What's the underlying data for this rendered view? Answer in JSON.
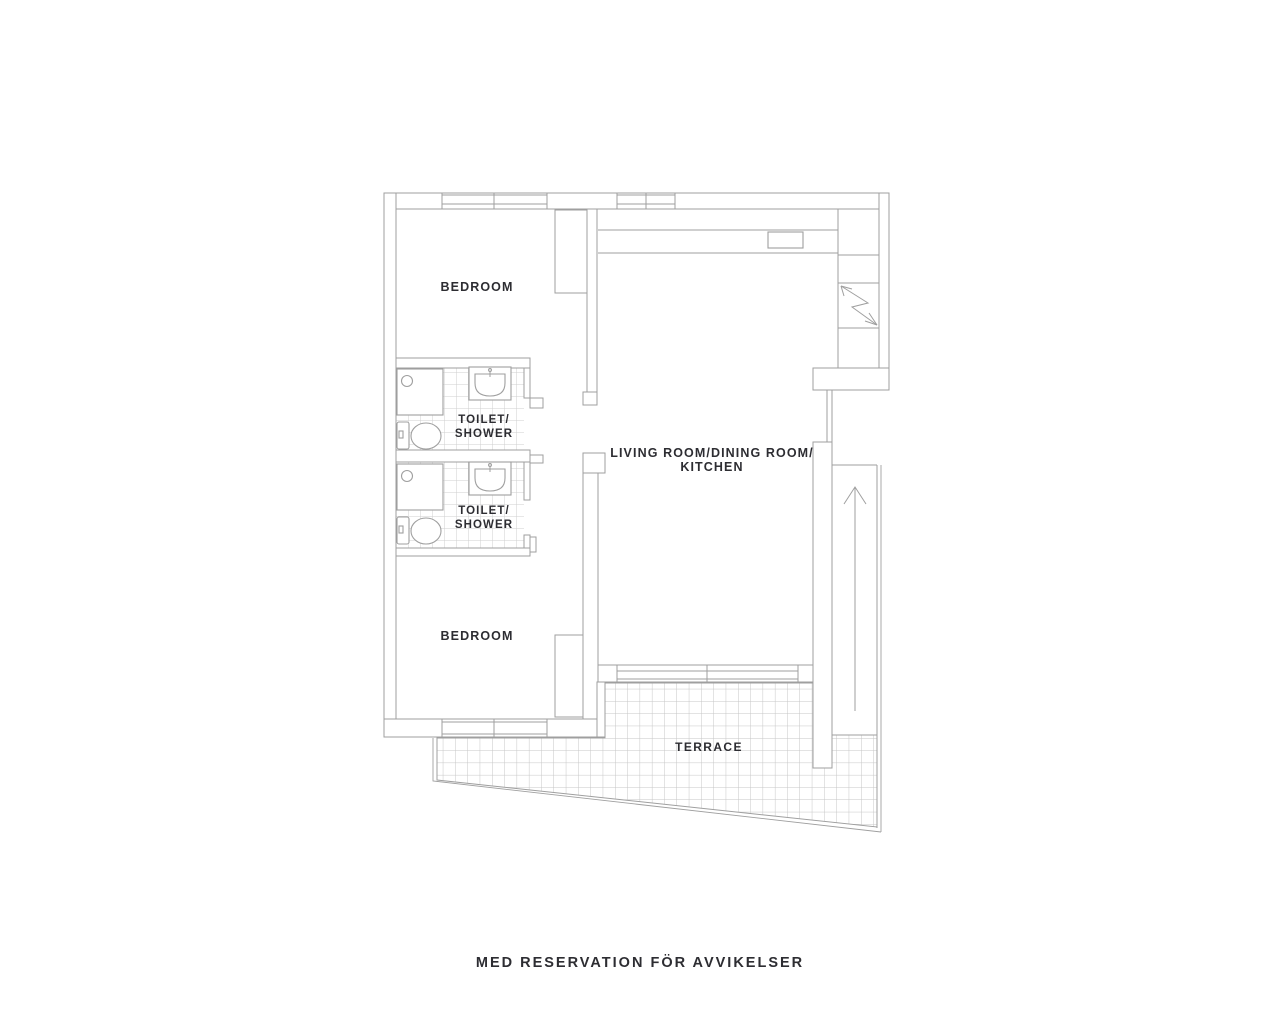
{
  "colors": {
    "background": "#ffffff",
    "line": "#9f9f9f",
    "grid_tile": "#cfcfcf",
    "terrace_grid": "#c6c6c6",
    "text": "#2d2d32"
  },
  "plan": {
    "bedroom_top": {
      "label": "BEDROOM"
    },
    "bedroom_bottom": {
      "label": "BEDROOM"
    },
    "toilet_shower_top": {
      "line1": "TOILET/",
      "line2": "SHOWER"
    },
    "toilet_shower_bottom": {
      "line1": "TOILET/",
      "line2": "SHOWER"
    },
    "living_room": {
      "line1": "LIVING ROOM/DINING ROOM/",
      "line2": "KITCHEN"
    },
    "terrace": {
      "label": "TERRACE"
    }
  },
  "footer": {
    "disclaimer": "MED RESERVATION FÖR AVVIKELSER"
  }
}
